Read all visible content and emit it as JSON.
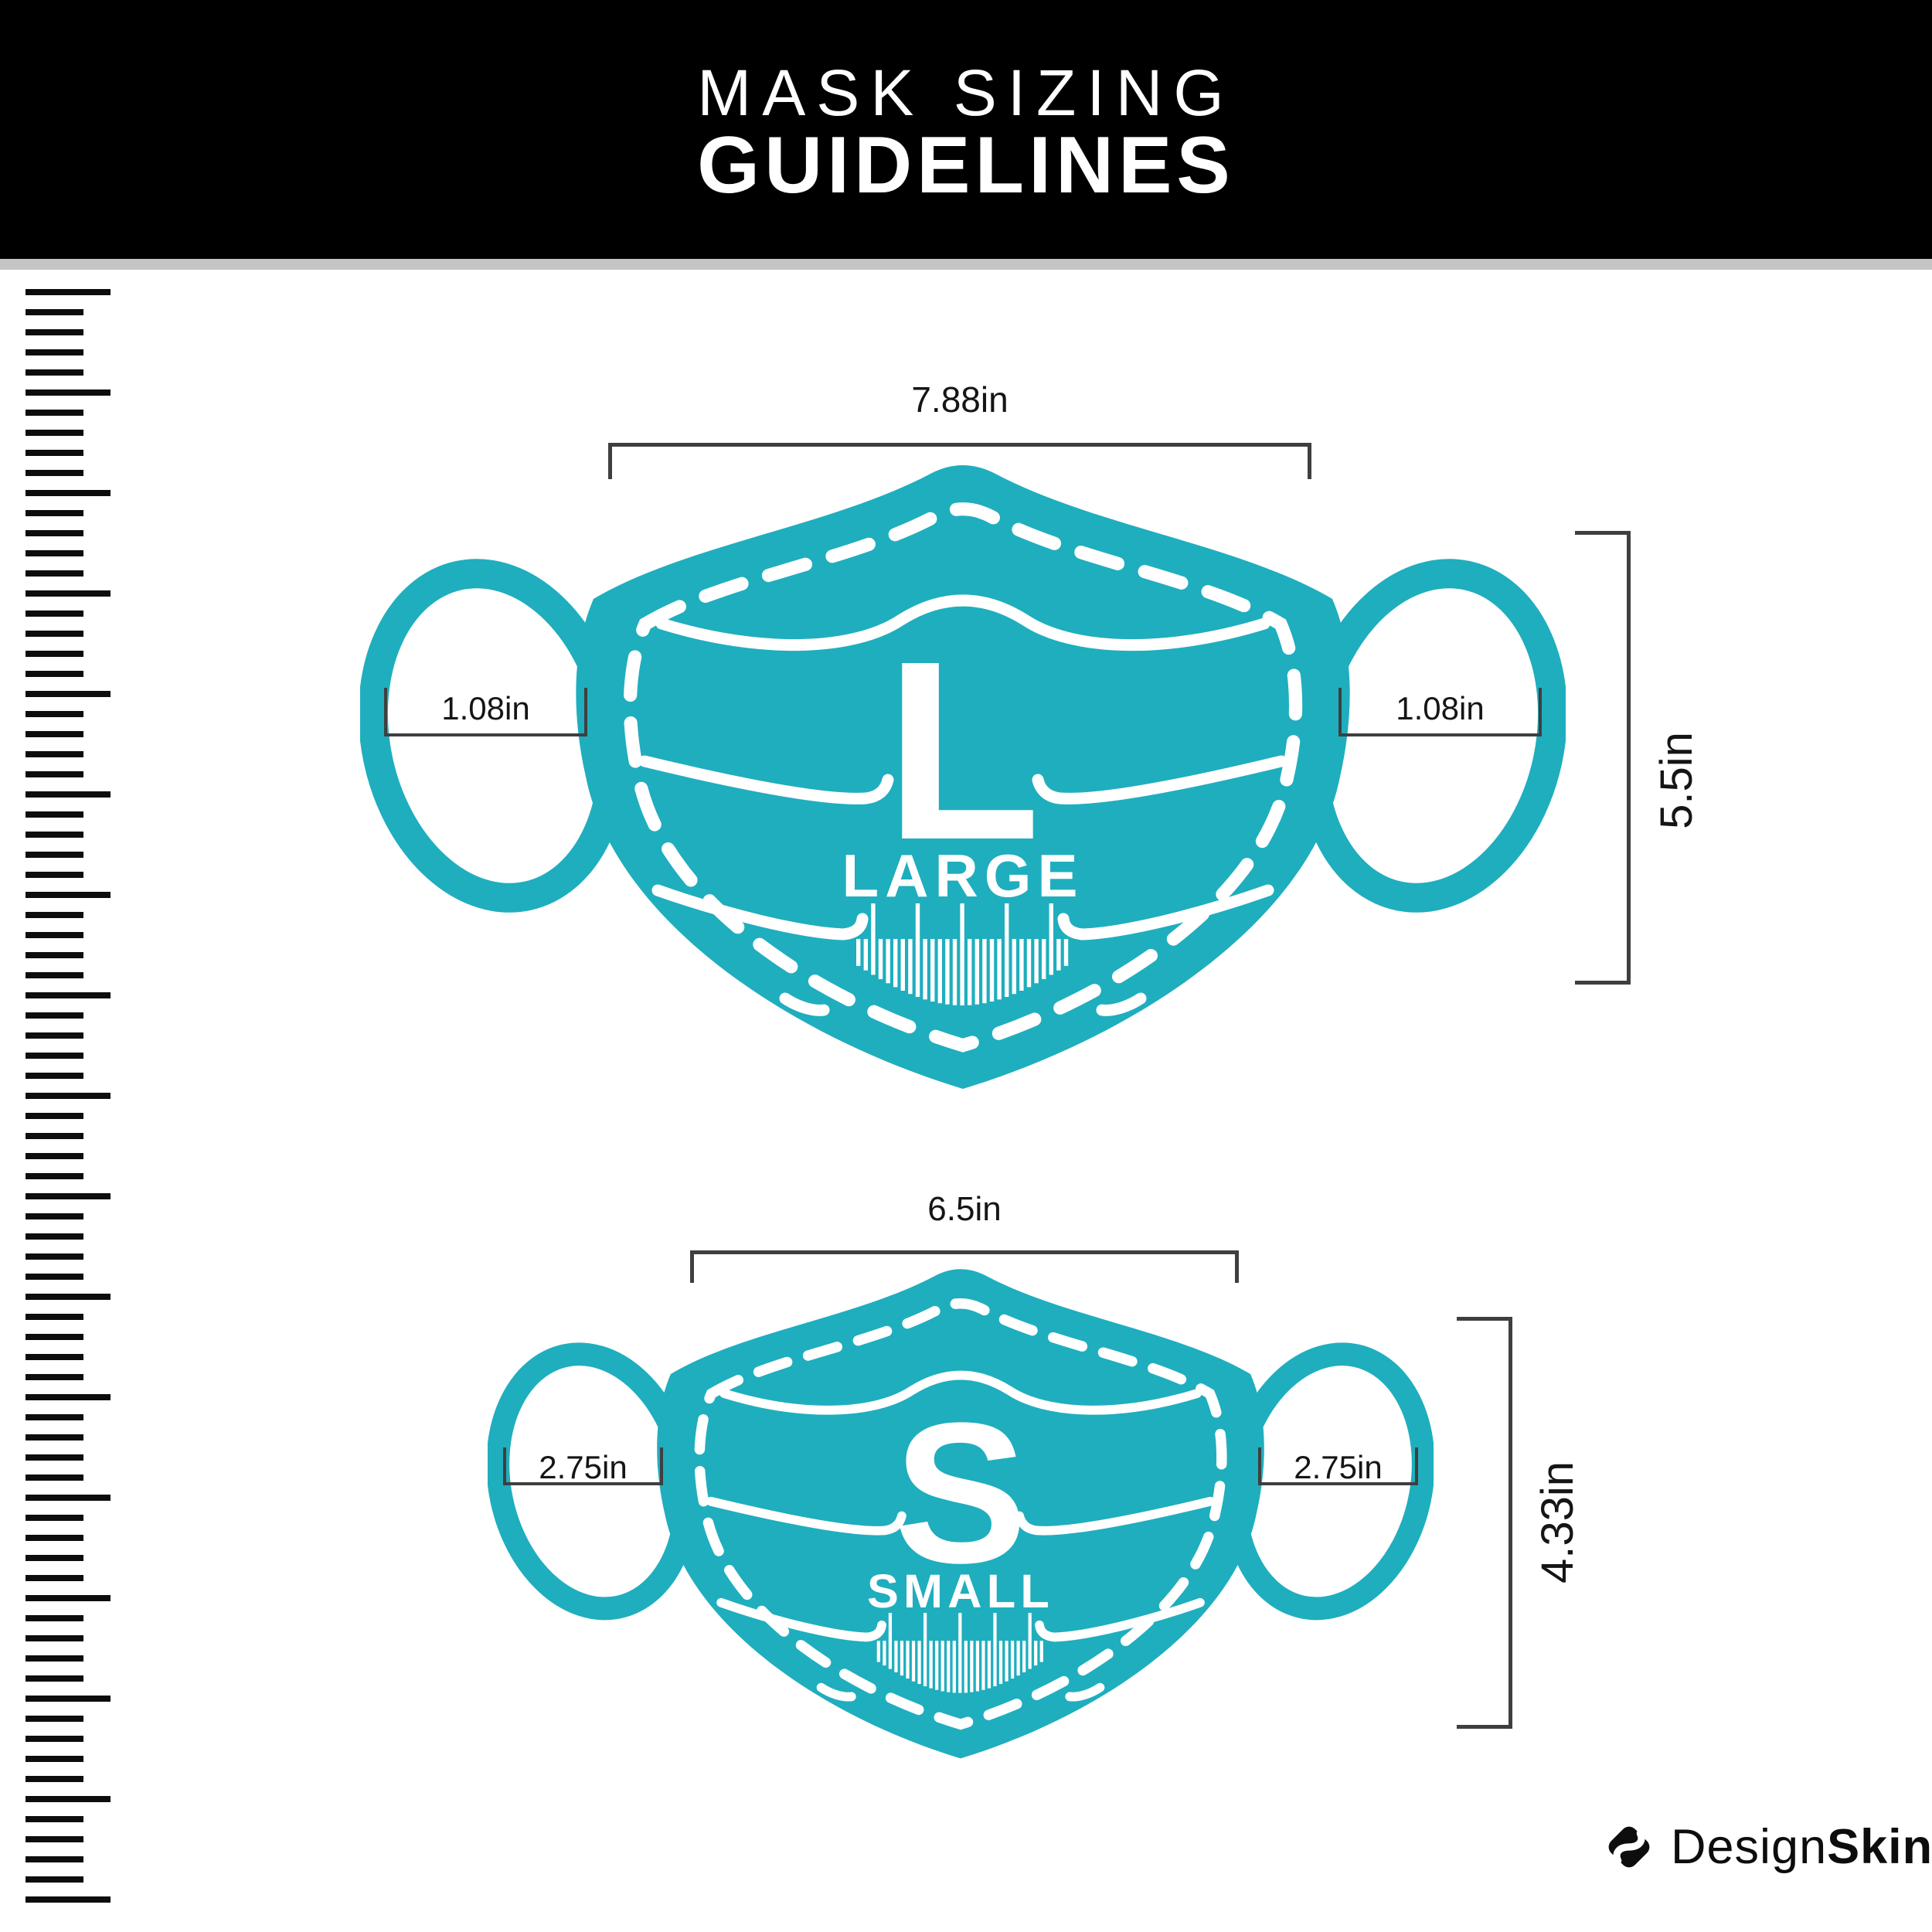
{
  "header": {
    "title_line1": "MASK SIZING",
    "title_line2": "GUIDELINES"
  },
  "masks": [
    {
      "id": "large",
      "letter": "L",
      "size_name": "LARGE",
      "width_label": "7.88in",
      "ear_label_left": "1.08in",
      "ear_label_right": "1.08in",
      "height_label": "5.5in"
    },
    {
      "id": "small",
      "letter": "S",
      "size_name": "SMALL",
      "width_label": "6.5in",
      "ear_label_left": "2.75in",
      "ear_label_right": "2.75in",
      "height_label": "4.33in"
    }
  ],
  "footer": {
    "brand_regular": "Design",
    "brand_bold": "Skinz"
  },
  "colors": {
    "teal": "#1FAEBE",
    "header_bg": "#000000",
    "divider": "#C5C5C5",
    "bracket": "#3F3F3F",
    "ink": "#0D0D0D"
  },
  "diagram_data": {
    "type": "size-guide",
    "title": "MASK SIZING GUIDELINES",
    "items": [
      {
        "name": "Large",
        "width_in": 7.88,
        "height_in": 5.5,
        "ear_loop_in": 1.08
      },
      {
        "name": "Small",
        "width_in": 6.5,
        "height_in": 4.33,
        "ear_loop_in": 2.75
      }
    ]
  }
}
